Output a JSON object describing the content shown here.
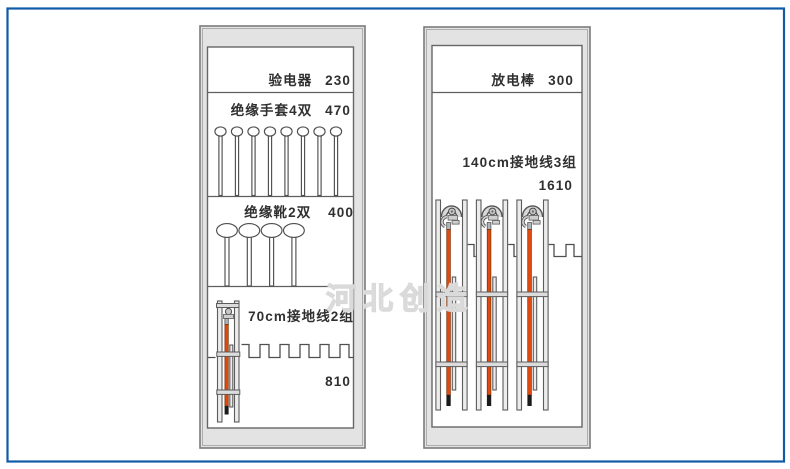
{
  "page": {
    "background": "#ffffff",
    "border_color": "#0f5ba8"
  },
  "watermark": {
    "text": "河北创造",
    "color": "#dadada"
  },
  "colors": {
    "cabinet_fill": "#e3e3e3",
    "cabinet_stroke": "#7b7b7b",
    "panel_fill": "#ffffff",
    "line": "#5f5f5f",
    "rail_fill": "#ececec",
    "rod_orange": "#e04a10",
    "rod_ferrule": "#aeb6bb",
    "rod_tip": "#1b1b1b",
    "text": "#303030"
  },
  "left_cabinet": {
    "sections": [
      {
        "label": "验电器",
        "value": "230"
      },
      {
        "label": "绝缘手套4双",
        "value": "470",
        "hanger_count": 8
      },
      {
        "label": "绝缘靴2双",
        "value": "400",
        "hanger_count": 4
      },
      {
        "label": "70cm接地线2组",
        "value": "810",
        "assembly_count": 1
      }
    ]
  },
  "right_cabinet": {
    "sections": [
      {
        "label": "放电棒",
        "value": "300"
      },
      {
        "label": "140cm接地线3组",
        "value": "1610",
        "assembly_count": 3
      }
    ]
  }
}
